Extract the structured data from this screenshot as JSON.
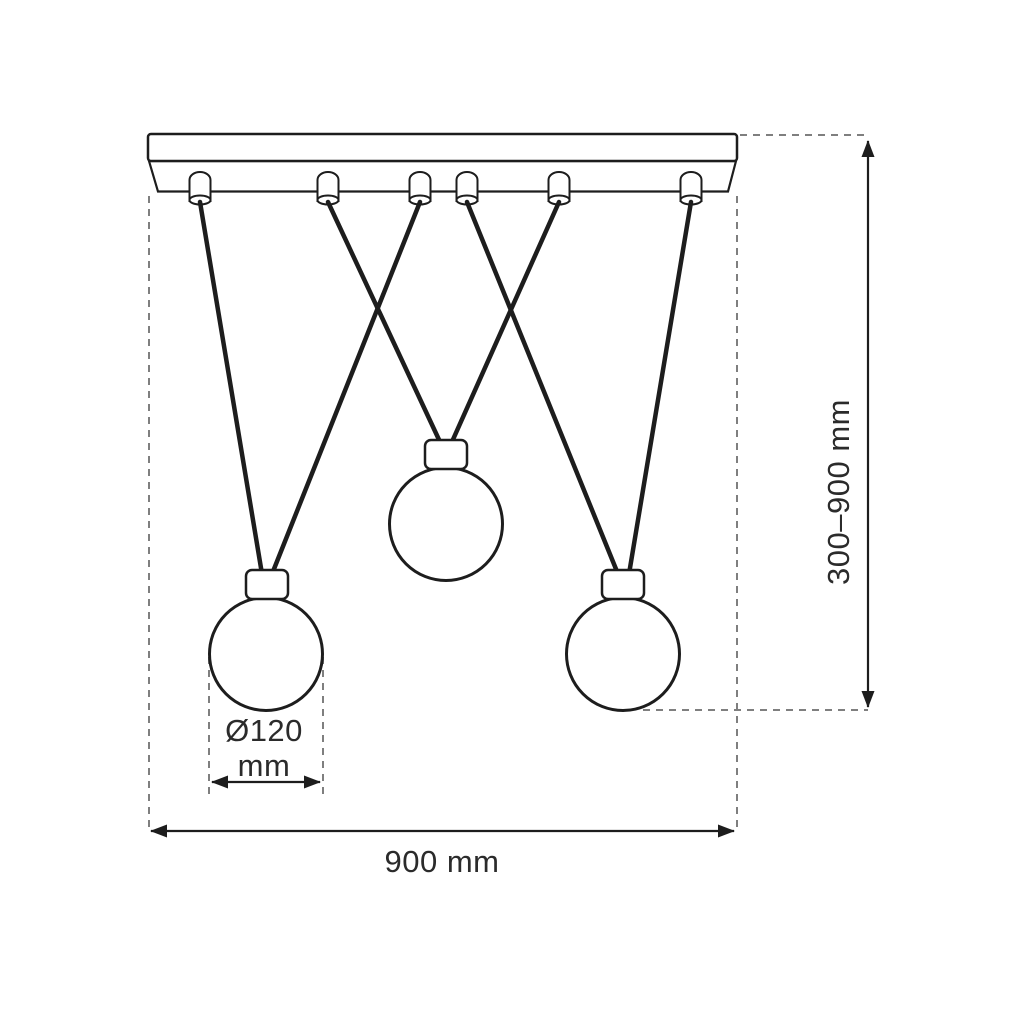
{
  "diagram": {
    "kind": "pendant-lamp-dimension-drawing",
    "fixture": {
      "bulb_count": 3,
      "cord_count": 6
    },
    "labels": {
      "height_range": "300–900 mm",
      "bar_width": "900 mm",
      "shade_diameter_value": "Ø120",
      "shade_diameter_unit": "mm"
    }
  },
  "colors": {
    "ink": "#1d1d1d",
    "dash": "#7f7f7f",
    "text": "#2b2b2b",
    "bg": "#ffffff"
  }
}
